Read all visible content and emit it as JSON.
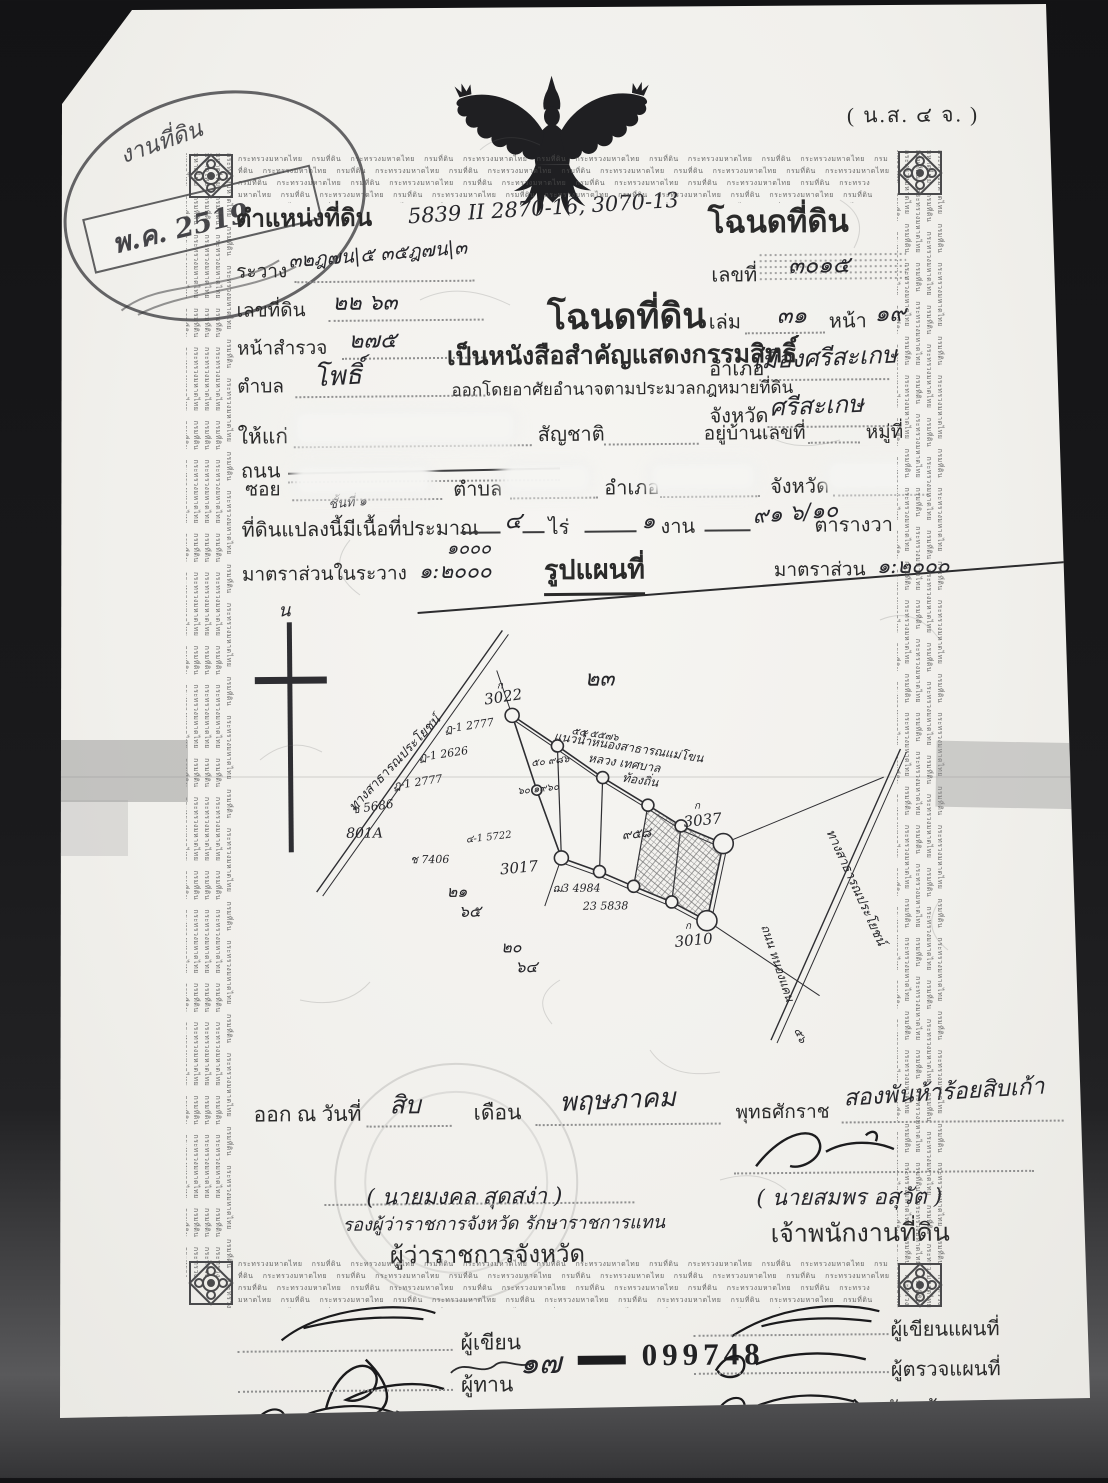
{
  "form_code": "( น.ส. ๔ จ. )",
  "corner_stamp": {
    "arc_text": "งานที่ดิน",
    "date": "พ.ค. 2519"
  },
  "border": {
    "micro_text": "กระทรวงมหาดไทย กรมที่ดิน"
  },
  "position": {
    "title": "ตำแหน่งที่ดิน",
    "sheet_note": "5839 II 2870-16, 3070-13",
    "rawang_label": "ระวาง",
    "rawang_value": "๓๒ฎ๗น|๕  ๓๕ฎ๗น|๓",
    "parcel_label": "เลขที่ดิน",
    "parcel_value": "๒๒  ๖๓",
    "survey_label": "หน้าสำรวจ",
    "survey_value": "๒๗๕",
    "tambon_label": "ตำบล",
    "tambon_value": "โพธิ์"
  },
  "deed": {
    "title": "โฉนดที่ดิน",
    "no_label": "เลขที่",
    "no_value": "๓๐๑๕",
    "book_label": "เล่ม",
    "book_value": "๓๑",
    "page_label": "หน้า",
    "page_value": "๑๙",
    "amphoe_label": "อำเภอ",
    "amphoe_value": "เมืองศรีสะเกษ",
    "province_label": "จังหวัด",
    "province_value": "ศรีสะเกษ"
  },
  "heading": {
    "title": "โฉนดที่ดิน",
    "subtitle": "เป็นหนังสือสำคัญแสดงกรรมสิทธิ์",
    "authority": "ออกโดยอาศัยอำนาจตามประมวลกฎหมายที่ดิน"
  },
  "grantee": {
    "to_label": "ให้แก่",
    "nationality_label": "สัญชาติ",
    "address_label": "อยู่บ้านเลขที่",
    "moo_label": "หมู่ที่",
    "road_label": "ถนน",
    "soi_label": "ซอย",
    "tambon_label": "ตำบล",
    "amphoe_label": "อำเภอ",
    "province_label": "จังหวัด"
  },
  "area": {
    "lead": "ที่ดินแปลงนี้มีเนื้อที่ประมาณ",
    "class_note": "ชั้นที่ ๑",
    "rai_value": "๔",
    "rai_label": "ไร่",
    "ngan_value": "๑",
    "ngan_label": "งาน",
    "wa_value": "๙๑ ๖/๑๐",
    "wa_label": "ตารางวา"
  },
  "scale": {
    "left_label": "มาตราส่วนในระวาง",
    "left_value": "๑:๒๐๐๐",
    "left_correction": "๑๐๐๐",
    "map_title": "รูปแผนที่",
    "right_label": "มาตราส่วน",
    "right_value": "๑:๒๐๐๐"
  },
  "map": {
    "north_label": "น",
    "annotations": [
      {
        "t": "น",
        "x": 44,
        "y": 16,
        "s": 18,
        "r": 0
      },
      {
        "t": "๒๓",
        "x": 350,
        "y": 88,
        "s": 22,
        "r": 0
      },
      {
        "t": "ก",
        "x": 262,
        "y": 90,
        "s": 10,
        "r": 0
      },
      {
        "t": "3022",
        "x": 250,
        "y": 106,
        "s": 15,
        "r": -8
      },
      {
        "t": "ฏ-1 2777",
        "x": 210,
        "y": 134,
        "s": 11,
        "r": -8
      },
      {
        "t": "ฏ-1 2626",
        "x": 184,
        "y": 162,
        "s": 11,
        "r": -8
      },
      {
        "t": "ฏ-1 2777",
        "x": 158,
        "y": 190,
        "s": 11,
        "r": -8
      },
      {
        "t": "ช 5686",
        "x": 116,
        "y": 214,
        "s": 12,
        "r": -8
      },
      {
        "t": "801A",
        "x": 110,
        "y": 238,
        "s": 14,
        "r": 0
      },
      {
        "t": "ช 7406",
        "x": 174,
        "y": 264,
        "s": 11,
        "r": 0
      },
      {
        "t": "3017",
        "x": 264,
        "y": 276,
        "s": 15,
        "r": -5
      },
      {
        "t": "ฌ3 4984",
        "x": 316,
        "y": 294,
        "s": 11,
        "r": 0
      },
      {
        "t": "23 5838",
        "x": 346,
        "y": 312,
        "s": 11,
        "r": 0
      },
      {
        "t": "๒๑",
        "x": 210,
        "y": 298,
        "s": 16,
        "r": 0
      },
      {
        "t": "๖๕",
        "x": 222,
        "y": 318,
        "s": 16,
        "r": 0
      },
      {
        "t": "๒๐",
        "x": 264,
        "y": 354,
        "s": 16,
        "r": 0
      },
      {
        "t": "๖๔",
        "x": 278,
        "y": 374,
        "s": 16,
        "r": 0
      },
      {
        "t": "๙๕๘",
        "x": 386,
        "y": 242,
        "s": 13,
        "r": -5
      },
      {
        "t": "ก",
        "x": 458,
        "y": 212,
        "s": 10,
        "r": 0
      },
      {
        "t": "3037",
        "x": 448,
        "y": 230,
        "s": 15,
        "r": -5
      },
      {
        "t": "ก",
        "x": 448,
        "y": 332,
        "s": 10,
        "r": 0
      },
      {
        "t": "3010",
        "x": 438,
        "y": 350,
        "s": 15,
        "r": -5
      },
      {
        "t": "๕๐ ๙๘๖",
        "x": 296,
        "y": 168,
        "s": 10,
        "r": -6
      },
      {
        "t": "๖๐ ๑๙๖๐",
        "x": 282,
        "y": 196,
        "s": 10,
        "r": -6
      },
      {
        "t": "๔-1 5722",
        "x": 230,
        "y": 244,
        "s": 10,
        "r": -6
      },
      {
        "t": "๕๕ ๕๕๗๖",
        "x": 336,
        "y": 136,
        "s": 10,
        "r": 9
      },
      {
        "t": "ทางสาธารณประโยชน์",
        "x": 118,
        "y": 212,
        "s": 13,
        "r": -46
      },
      {
        "t": "แนวน้ำหนองสาธารณแม่โขน",
        "x": 318,
        "y": 142,
        "s": 12,
        "r": 9
      },
      {
        "t": "หลวง เทศบาล",
        "x": 352,
        "y": 164,
        "s": 12,
        "r": 9
      },
      {
        "t": "ท้องถิ่น",
        "x": 386,
        "y": 184,
        "s": 12,
        "r": 9
      },
      {
        "t": "ทางสาธารณประโยชน์",
        "x": 590,
        "y": 236,
        "s": 13,
        "r": 66
      },
      {
        "t": "ถนน หนองแคน",
        "x": 524,
        "y": 330,
        "s": 12,
        "r": 72
      },
      {
        "t": "๕๖",
        "x": 556,
        "y": 434,
        "s": 11,
        "r": 66
      }
    ]
  },
  "issue": {
    "lead": "ออก ณ วันที่",
    "day": "สิบ",
    "month_label": "เดือน",
    "month": "พฤษภาคม",
    "era_label": "พุทธศักราช",
    "year": "สองพันห้าร้อยสิบเก้า"
  },
  "signers": {
    "left_name": "( นายมงคล  สุดสง่า )",
    "left_role1": "รองผู้ว่าราชการจังหวัด รักษาราชการแทน",
    "left_role2": "ผู้ว่าราชการจังหวัด",
    "right_name": "( นายสมพร  อสุวัต )",
    "right_role": "เจ้าพนักงานที่ดิน"
  },
  "footer": {
    "left_roles": [
      "ผู้เขียน",
      "ผู้ทาน",
      "ผู้ตรวจ"
    ],
    "right_roles": [
      "ผู้เขียนแผนที่",
      "ผู้ตรวจแผนที่",
      "หัวหน้าการ"
    ],
    "serial_thai": "๑๗",
    "serial_arabic": "099748"
  }
}
